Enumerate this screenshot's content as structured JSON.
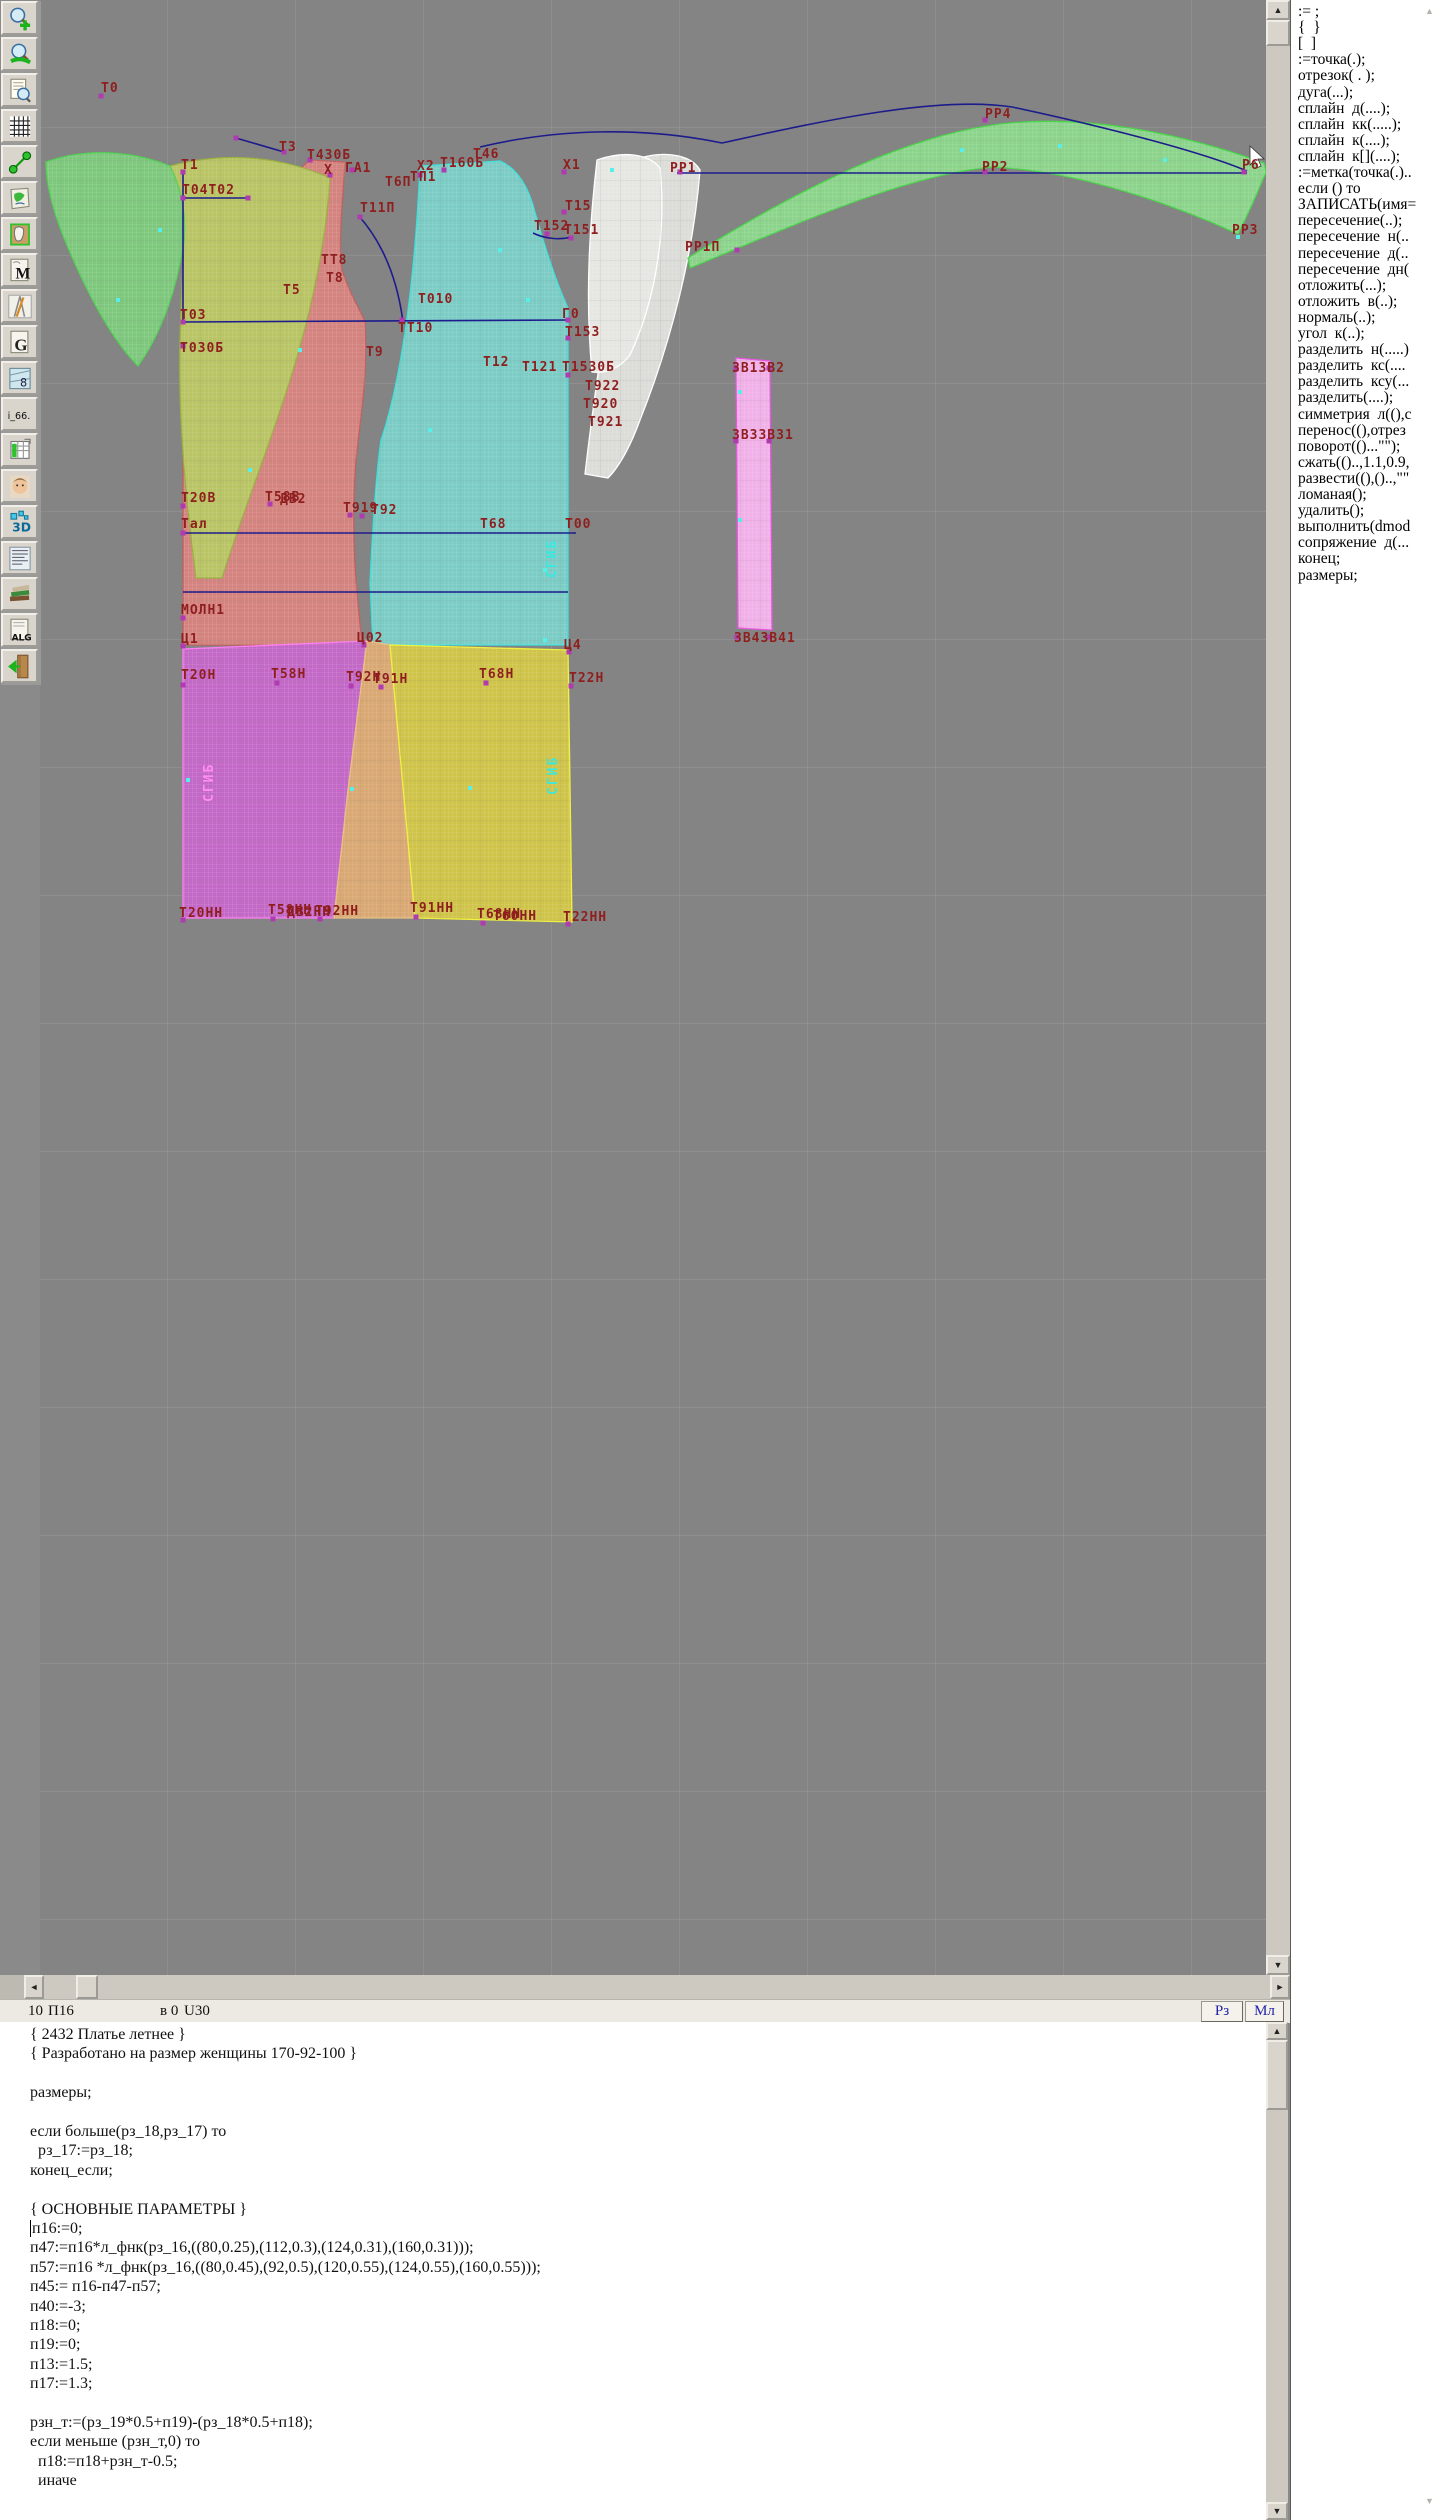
{
  "colors": {
    "canvas_bg": "#848484",
    "label": "#8f1f1f",
    "construction_line": "#1c1c8c",
    "piece_green": "#7ec87e",
    "piece_yellow_green": "#b9c464",
    "piece_red": "#d4837f",
    "piece_cyan": "#7cccc6",
    "piece_white": "#e6e6e2",
    "piece_band_green": "#8cd48c",
    "piece_pink": "#f2b0e8",
    "piece_violet": "#c468c8",
    "piece_tan": "#d9a873",
    "piece_yellow": "#cfc449",
    "fold_cyan": "#3ae8e0",
    "fold_pink": "#ff8ef0"
  },
  "toolbar": {
    "buttons": [
      {
        "name": "zoom-in-button",
        "icon": "zoomin",
        "text": ""
      },
      {
        "name": "zoom-out-button",
        "icon": "zoomout",
        "text": ""
      },
      {
        "name": "page-preview-button",
        "icon": "preview",
        "text": ""
      },
      {
        "name": "grid-button",
        "icon": "grid",
        "text": ""
      },
      {
        "name": "segment-tool-button",
        "icon": "segment",
        "text": ""
      },
      {
        "name": "curve-map-button",
        "icon": "map",
        "text": ""
      },
      {
        "name": "pattern-document-button",
        "icon": "pattern",
        "text": ""
      },
      {
        "name": "m-document-button",
        "icon": "mpage",
        "text": "M"
      },
      {
        "name": "drafting-tools-button",
        "icon": "draft",
        "text": ""
      },
      {
        "name": "g-document-button",
        "icon": "gpage",
        "text": "G"
      },
      {
        "name": "measurements-button",
        "icon": "ruler",
        "text": "8"
      },
      {
        "name": "i66-button",
        "icon": "txt",
        "text": "i_66."
      },
      {
        "name": "table-chart-button",
        "icon": "table",
        "text": ""
      },
      {
        "name": "portrait-button",
        "icon": "face",
        "text": ""
      },
      {
        "name": "view-3d-button",
        "icon": "cube",
        "text": "3D"
      },
      {
        "name": "text-document-button",
        "icon": "doc",
        "text": ""
      },
      {
        "name": "books-button",
        "icon": "books",
        "text": ""
      },
      {
        "name": "alg-document-button",
        "icon": "alg",
        "text": "ALG"
      },
      {
        "name": "exit-button",
        "icon": "exit",
        "text": ""
      }
    ]
  },
  "command_panel": {
    "items": [
      ":= ;",
      "{  }",
      "[  ]",
      ":=точка(.);",
      "отрезок( . );",
      "дуга(...);",
      "сплайн  д(....);",
      "сплайн  кк(.....);",
      "сплайн  к(....);",
      "сплайн  к[](....);",
      ":=метка(точка(.)..",
      "если () то",
      "ЗАПИСАТЬ(имя=",
      "пересечение(..);",
      "пересечение  н(..",
      "пересечение  д(..",
      "пересечение  дн(",
      "отложить(...);",
      "отложить  в(..);",
      "нормаль(..);",
      "угол  к(..);",
      "разделить  н(.....)",
      "разделить  кс(....",
      "разделить  ксу(...",
      "разделить(....);",
      "симметрия  л((),с",
      "перенос((),отрез",
      "поворот(()...\"\");",
      "сжать(()..,1.1,0.9,",
      "развести((),()..,\"\"",
      "ломаная();",
      "удалить();",
      "выполнить(dmod",
      "сопряжение  д(...",
      "конец;",
      "размеры;"
    ]
  },
  "status_bar": {
    "num": "10",
    "field1": "П16",
    "field2": "в 0",
    "field3": "U30",
    "btn_rz": "Рз",
    "btn_ml": "Мл"
  },
  "code_editor": {
    "caret_line": 10,
    "lines": [
      "{ 2432 Платье летнее }",
      "{ Разработано на размер женщины 170-92-100 }",
      "",
      "размеры;",
      "",
      "если больше(рз_18,рз_17) то",
      "  рз_17:=рз_18;",
      "конец_если;",
      "",
      "{ ОСНОВНЫЕ ПАРАМЕТРЫ }",
      "п16:=0;",
      "п47:=п16*л_фнк(рз_16,((80,0.25),(112,0.3),(124,0.31),(160,0.31)));",
      "п57:=п16 *л_фнк(рз_16,((80,0.45),(92,0.5),(120,0.55),(124,0.55),(160,0.55)));",
      "п45:= п16-п47-п57;",
      "п40:=-3;",
      "п18:=0;",
      "п19:=0;",
      "п13:=1.5;",
      "п17:=1.3;",
      "",
      "рзн_т:=(рз_19*0.5+п19)-(рз_18*0.5+п18);",
      "если меньше (рзн_т,0) то",
      "  п18:=п18+рзн_т-0.5;",
      "  иначе"
    ]
  },
  "canvas": {
    "labels": [
      {
        "t": "Т0",
        "x": 101,
        "y": 82
      },
      {
        "t": "Т1",
        "x": 181,
        "y": 159
      },
      {
        "t": "Т04Т02",
        "x": 182,
        "y": 184
      },
      {
        "t": "Т3",
        "x": 279,
        "y": 141
      },
      {
        "t": "Т430Б",
        "x": 307,
        "y": 149
      },
      {
        "t": "Х",
        "x": 324,
        "y": 164
      },
      {
        "t": "ГА1",
        "x": 345,
        "y": 162
      },
      {
        "t": "Т6П",
        "x": 385,
        "y": 176
      },
      {
        "t": "ТП1",
        "x": 410,
        "y": 171
      },
      {
        "t": "Х2",
        "x": 417,
        "y": 160
      },
      {
        "t": "Т160Б",
        "x": 440,
        "y": 157
      },
      {
        "t": "Т46",
        "x": 473,
        "y": 148
      },
      {
        "t": "Х1",
        "x": 563,
        "y": 159
      },
      {
        "t": "Т15",
        "x": 565,
        "y": 200
      },
      {
        "t": "Т152",
        "x": 534,
        "y": 220
      },
      {
        "t": "Т151",
        "x": 564,
        "y": 224
      },
      {
        "t": "Т11П",
        "x": 360,
        "y": 202
      },
      {
        "t": "ТТ8",
        "x": 321,
        "y": 254
      },
      {
        "t": "Т8",
        "x": 326,
        "y": 272
      },
      {
        "t": "Т5",
        "x": 283,
        "y": 284
      },
      {
        "t": "Т03",
        "x": 180,
        "y": 309
      },
      {
        "t": "Т030Б",
        "x": 180,
        "y": 342
      },
      {
        "t": "Т010",
        "x": 418,
        "y": 293
      },
      {
        "t": "ТТ10",
        "x": 398,
        "y": 322
      },
      {
        "t": "Т9",
        "x": 366,
        "y": 346
      },
      {
        "t": "Г0",
        "x": 562,
        "y": 308
      },
      {
        "t": "Т153",
        "x": 565,
        "y": 326
      },
      {
        "t": "РР1",
        "x": 670,
        "y": 162
      },
      {
        "t": "РР1П",
        "x": 685,
        "y": 241
      },
      {
        "t": "РР4",
        "x": 985,
        "y": 108
      },
      {
        "t": "РР2",
        "x": 982,
        "y": 161
      },
      {
        "t": "Р6",
        "x": 1242,
        "y": 159
      },
      {
        "t": "РР3",
        "x": 1232,
        "y": 224
      },
      {
        "t": "Т12",
        "x": 483,
        "y": 356
      },
      {
        "t": "Т121",
        "x": 522,
        "y": 361
      },
      {
        "t": "Т1530Б",
        "x": 562,
        "y": 361
      },
      {
        "t": "Т922",
        "x": 585,
        "y": 380
      },
      {
        "t": "Т920",
        "x": 583,
        "y": 398
      },
      {
        "t": "Т921",
        "x": 588,
        "y": 416
      },
      {
        "t": "3В13В2",
        "x": 732,
        "y": 362
      },
      {
        "t": "3В33В31",
        "x": 732,
        "y": 429
      },
      {
        "t": "3В43В41",
        "x": 734,
        "y": 632
      },
      {
        "t": "Т20В",
        "x": 181,
        "y": 492
      },
      {
        "t": "Т58В",
        "x": 265,
        "y": 491
      },
      {
        "t": "ДВ2",
        "x": 280,
        "y": 493
      },
      {
        "t": "Т919",
        "x": 343,
        "y": 502
      },
      {
        "t": "Т92",
        "x": 371,
        "y": 504
      },
      {
        "t": "Тал",
        "x": 181,
        "y": 518
      },
      {
        "t": "Т68",
        "x": 480,
        "y": 518
      },
      {
        "t": "Т00",
        "x": 565,
        "y": 518
      },
      {
        "t": "МОЛН1",
        "x": 181,
        "y": 604
      },
      {
        "t": "Ц1",
        "x": 181,
        "y": 633
      },
      {
        "t": "Ц02",
        "x": 357,
        "y": 632
      },
      {
        "t": "Ц4",
        "x": 564,
        "y": 639
      },
      {
        "t": "Т20Н",
        "x": 181,
        "y": 669
      },
      {
        "t": "Т58Н",
        "x": 271,
        "y": 668
      },
      {
        "t": "Т92Н",
        "x": 346,
        "y": 671
      },
      {
        "t": "Т91Н",
        "x": 373,
        "y": 673
      },
      {
        "t": "Т68Н",
        "x": 479,
        "y": 668
      },
      {
        "t": "Т22Н",
        "x": 569,
        "y": 672
      },
      {
        "t": "Т20НН",
        "x": 179,
        "y": 907
      },
      {
        "t": "Т58НН",
        "x": 268,
        "y": 904
      },
      {
        "t": "ДВ2НН",
        "x": 287,
        "y": 906
      },
      {
        "t": "Т92НН",
        "x": 315,
        "y": 905
      },
      {
        "t": "Т91НН",
        "x": 410,
        "y": 902
      },
      {
        "t": "Т68НН",
        "x": 477,
        "y": 908
      },
      {
        "t": "Т60НН",
        "x": 493,
        "y": 910
      },
      {
        "t": "Т22НН",
        "x": 563,
        "y": 911
      }
    ],
    "vertical_labels": [
      {
        "t": "СГИБ",
        "x": 546,
        "y": 578,
        "color": "#3ae8e0"
      },
      {
        "t": "СГИБ",
        "x": 547,
        "y": 795,
        "color": "#3ae8e0"
      },
      {
        "t": "СГИБ",
        "x": 203,
        "y": 802,
        "color": "#ff8ef0"
      }
    ],
    "points_violet": [
      [
        101,
        96
      ],
      [
        183,
        172
      ],
      [
        183,
        198
      ],
      [
        248,
        198
      ],
      [
        183,
        322
      ],
      [
        183,
        346
      ],
      [
        236,
        138
      ],
      [
        284,
        152
      ],
      [
        330,
        175
      ],
      [
        352,
        170
      ],
      [
        420,
        175
      ],
      [
        444,
        170
      ],
      [
        564,
        172
      ],
      [
        564,
        212
      ],
      [
        547,
        234
      ],
      [
        571,
        238
      ],
      [
        568,
        320
      ],
      [
        568,
        338
      ],
      [
        568,
        375
      ],
      [
        680,
        172
      ],
      [
        737,
        250
      ],
      [
        985,
        120
      ],
      [
        985,
        172
      ],
      [
        1244,
        172
      ],
      [
        736,
        368
      ],
      [
        769,
        368
      ],
      [
        736,
        441
      ],
      [
        769,
        441
      ],
      [
        737,
        637
      ],
      [
        769,
        637
      ],
      [
        183,
        506
      ],
      [
        270,
        504
      ],
      [
        350,
        515
      ],
      [
        362,
        516
      ],
      [
        183,
        533
      ],
      [
        183,
        618
      ],
      [
        183,
        646
      ],
      [
        364,
        645
      ],
      [
        569,
        652
      ],
      [
        183,
        685
      ],
      [
        277,
        683
      ],
      [
        351,
        686
      ],
      [
        381,
        687
      ],
      [
        486,
        683
      ],
      [
        571,
        686
      ],
      [
        183,
        920
      ],
      [
        273,
        919
      ],
      [
        320,
        919
      ],
      [
        416,
        917
      ],
      [
        483,
        923
      ],
      [
        568,
        924
      ],
      [
        360,
        217
      ],
      [
        402,
        320
      ],
      [
        310,
        160
      ]
    ],
    "points_cyan": [
      [
        118,
        300
      ],
      [
        160,
        230
      ],
      [
        300,
        350
      ],
      [
        250,
        470
      ],
      [
        188,
        780
      ],
      [
        352,
        789
      ],
      [
        470,
        788
      ],
      [
        545,
        570
      ],
      [
        545,
        640
      ],
      [
        500,
        250
      ],
      [
        430,
        430
      ],
      [
        740,
        392
      ],
      [
        740,
        520
      ],
      [
        962,
        150
      ],
      [
        1060,
        146
      ],
      [
        1165,
        160
      ],
      [
        1238,
        237
      ],
      [
        612,
        170
      ],
      [
        528,
        300
      ]
    ]
  }
}
